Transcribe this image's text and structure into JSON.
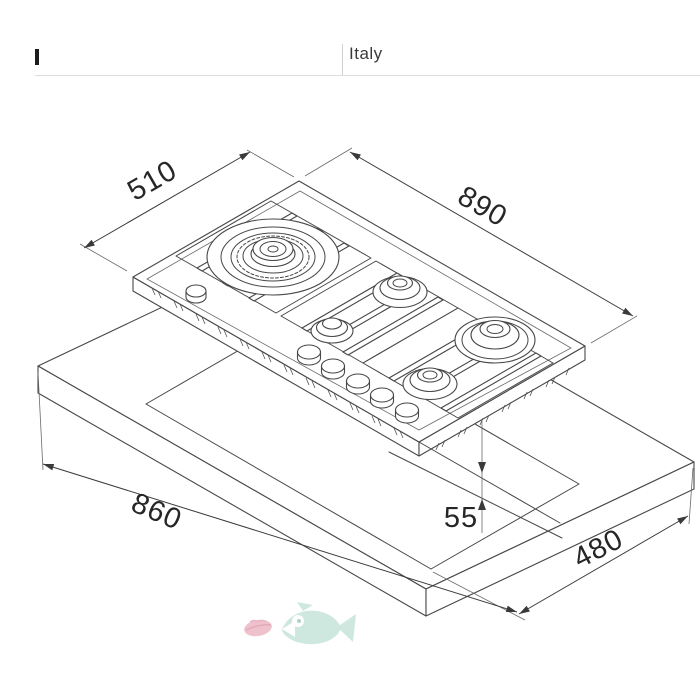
{
  "header": {
    "country": "Italy"
  },
  "figure": {
    "description": "Isometric installation drawing of a 5-burner gas hob above a worktop with rectangular cut-out",
    "burner_count": "5"
  },
  "dims": {
    "hob_width": "510",
    "hob_length": "890",
    "cutout_length": "860",
    "front_gap": "55",
    "cutout_width": "480"
  },
  "colors": {
    "line": "#474747",
    "fish": "#c7e5da",
    "lips": "#edb7c5"
  }
}
